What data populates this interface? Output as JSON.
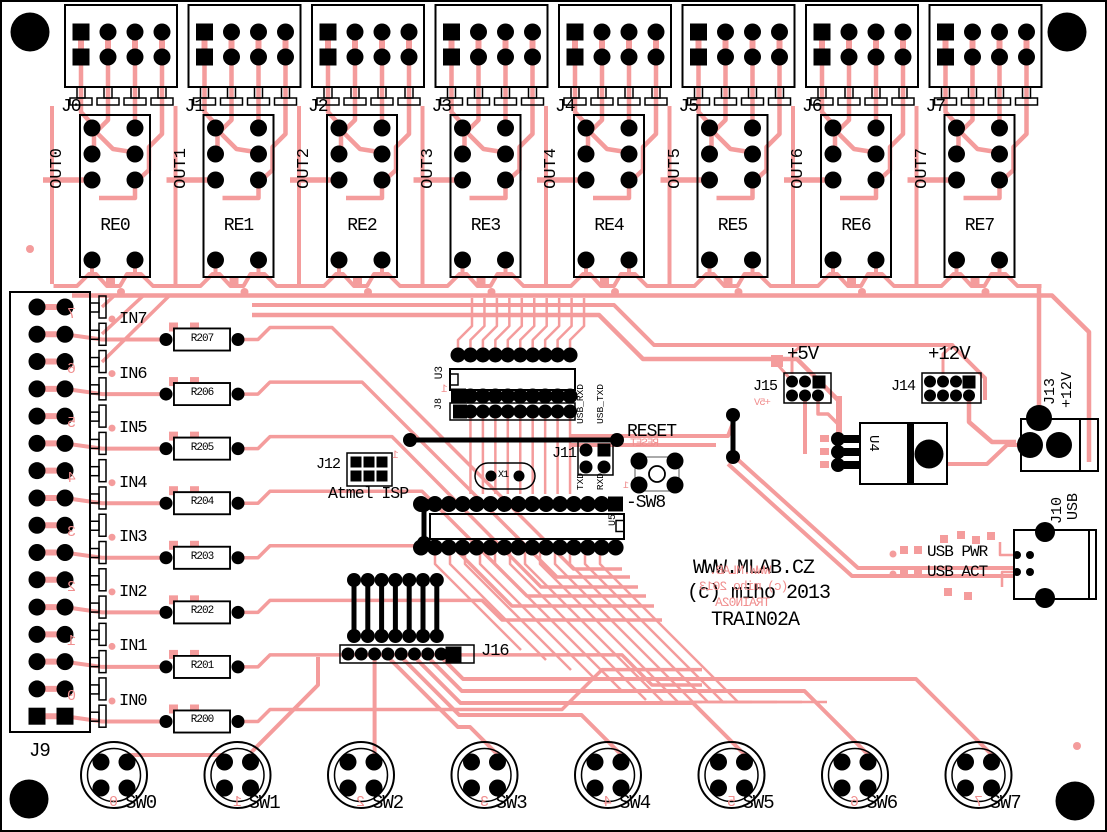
{
  "meta": {
    "board_name": "TRAIN02A"
  },
  "colors": {
    "trace": "#F49C9C",
    "mirror_silk": "#F08E8E",
    "silk": "#000000",
    "background": "#FFFFFF"
  },
  "title_block": {
    "line1": "WWW.MLAB.CZ",
    "line2": "(c) miho 2013",
    "line3": "TRAIN02A",
    "mirror_line1": "WWW.MLAB.",
    "mirror_line2": "(c) miho 2013",
    "mirror_line3": "TRAIN02A"
  },
  "relay_channels": [
    {
      "connector": "J0",
      "output": "OUT0",
      "relay": "RE0"
    },
    {
      "connector": "J1",
      "output": "OUT1",
      "relay": "RE1"
    },
    {
      "connector": "J2",
      "output": "OUT2",
      "relay": "RE2"
    },
    {
      "connector": "J3",
      "output": "OUT3",
      "relay": "RE3"
    },
    {
      "connector": "J4",
      "output": "OUT4",
      "relay": "RE4"
    },
    {
      "connector": "J5",
      "output": "OUT5",
      "relay": "RE5"
    },
    {
      "connector": "J6",
      "output": "OUT6",
      "relay": "RE6"
    },
    {
      "connector": "J7",
      "output": "OUT7",
      "relay": "RE7"
    }
  ],
  "input_connector": {
    "label": "J9",
    "mirror_digits": [
      "7",
      "6",
      "5",
      "4",
      "3",
      "2",
      "1",
      "0"
    ]
  },
  "input_channels": [
    {
      "label": "IN7",
      "resistor": "R207"
    },
    {
      "label": "IN6",
      "resistor": "R206"
    },
    {
      "label": "IN5",
      "resistor": "R205"
    },
    {
      "label": "IN4",
      "resistor": "R204"
    },
    {
      "label": "IN3",
      "resistor": "R203"
    },
    {
      "label": "IN2",
      "resistor": "R202"
    },
    {
      "label": "IN1",
      "resistor": "R201"
    },
    {
      "label": "IN0",
      "resistor": "R200"
    }
  ],
  "switches": [
    {
      "label": "SW0",
      "mirror_digit": "0"
    },
    {
      "label": "SW1",
      "mirror_digit": "1"
    },
    {
      "label": "SW2",
      "mirror_digit": "2"
    },
    {
      "label": "SW3",
      "mirror_digit": "3"
    },
    {
      "label": "SW4",
      "mirror_digit": "4"
    },
    {
      "label": "SW5",
      "mirror_digit": "5"
    },
    {
      "label": "SW6",
      "mirror_digit": "6"
    },
    {
      "label": "SW7",
      "mirror_digit": "7"
    }
  ],
  "logic": {
    "u3": "U3",
    "u3_pin1": "1",
    "j8": "J8",
    "u5": "U5",
    "crystal": "X1"
  },
  "isp": {
    "connector": "J12",
    "name": "Atmel ISP",
    "pin1": "1"
  },
  "serial_jumper": {
    "connector": "J11",
    "top_left": "USB_RXD",
    "top_right": "USB_TXD",
    "bottom_left": "TXD",
    "bottom_right": "RXD"
  },
  "reset": {
    "label": "RESET",
    "mirror_label": "RESET",
    "switch_label": "-SW8",
    "mirror_pin": "1"
  },
  "power": {
    "rail_5v": "+5V",
    "rail_5v_mirror": "+5V",
    "header_5v": "J15",
    "rail_12v": "+12V",
    "header_12v": "J14",
    "regulator": "U4",
    "jack_label": "J13",
    "jack_voltage": "+12V"
  },
  "usb": {
    "connector": "J10",
    "label": "USB",
    "pwr_led": "USB PWR",
    "act_led": "USB ACT"
  },
  "aux_header": {
    "label": "J16"
  }
}
